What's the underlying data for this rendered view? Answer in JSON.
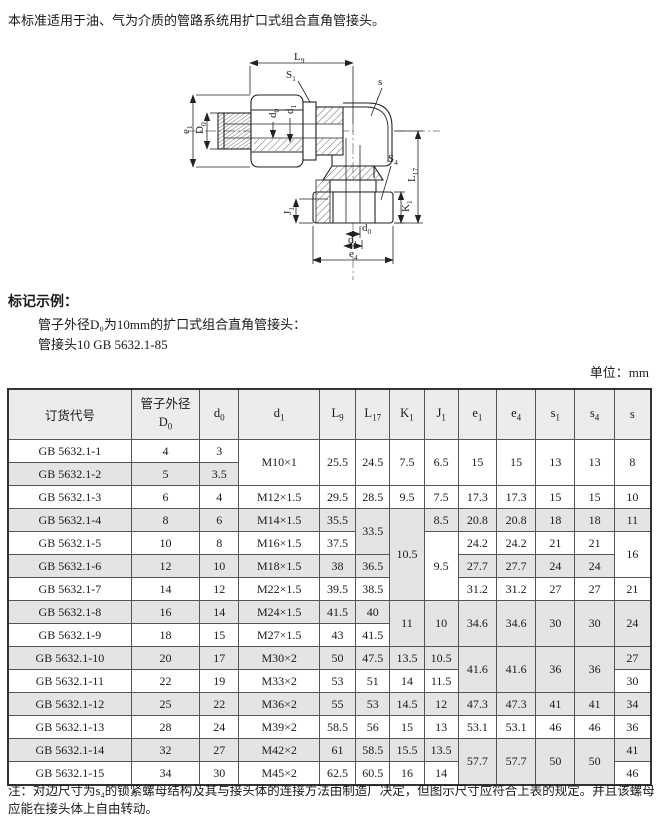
{
  "intro": "本标准适用于油、气为介质的管路系统用扩口式组合直角管接头。",
  "example": {
    "heading": "标记示例：",
    "line1": "管子外径D₀为10mm的扩口式组合直角管接头：",
    "line2": "管接头10 GB 5632.1-85"
  },
  "unit_label": "单位：mm",
  "diagram": {
    "L9": {
      "base": "L",
      "sub": "9"
    },
    "S1": {
      "base": "S",
      "sub": "1"
    },
    "s": {
      "base": "s",
      "sub": ""
    },
    "e1": {
      "base": "e",
      "sub": "1"
    },
    "D0": {
      "base": "D",
      "sub": "0"
    },
    "d0_top": {
      "base": "d",
      "sub": "0"
    },
    "d1_top": {
      "base": "d",
      "sub": "1"
    },
    "L17": {
      "base": "L",
      "sub": "17"
    },
    "S4": {
      "base": "S",
      "sub": "4"
    },
    "K1": {
      "base": "K",
      "sub": "1"
    },
    "J1": {
      "base": "J",
      "sub": "1"
    },
    "d0_bottom": {
      "base": "d",
      "sub": "0"
    },
    "d1_bottom": {
      "base": "d",
      "sub": "1"
    },
    "e4": {
      "base": "e",
      "sub": "4"
    }
  },
  "table": {
    "columns": [
      {
        "label": "订货代号",
        "w": 121
      },
      {
        "line1": "管子外径",
        "base": "D",
        "sub": "0",
        "w": 67
      },
      {
        "base": "d",
        "sub": "0",
        "w": 38
      },
      {
        "base": "d",
        "sub": "1",
        "w": 79
      },
      {
        "base": "L",
        "sub": "9",
        "w": 35
      },
      {
        "base": "L",
        "sub": "17",
        "w": 33
      },
      {
        "base": "K",
        "sub": "1",
        "w": 33
      },
      {
        "base": "J",
        "sub": "1",
        "w": 33
      },
      {
        "base": "e",
        "sub": "1",
        "w": 37
      },
      {
        "base": "e",
        "sub": "4",
        "w": 38
      },
      {
        "base": "s",
        "sub": "1",
        "w": 38
      },
      {
        "base": "s",
        "sub": "4",
        "w": 38
      },
      {
        "base": "s",
        "sub": "",
        "w": 35
      }
    ],
    "rows": [
      {
        "code": "GB 5632.1-1",
        "shaded": false,
        "cells": [
          {
            "v": "4"
          },
          {
            "v": "3"
          },
          {
            "v": "M10×1",
            "rs": 2
          },
          {
            "v": "25.5",
            "rs": 2
          },
          {
            "v": "24.5",
            "rs": 2
          },
          {
            "v": "7.5",
            "rs": 2
          },
          {
            "v": "6.5",
            "rs": 2
          },
          {
            "v": "15",
            "rs": 2
          },
          {
            "v": "15",
            "rs": 2
          },
          {
            "v": "13",
            "rs": 2
          },
          {
            "v": "13",
            "rs": 2
          },
          {
            "v": "8",
            "rs": 2
          }
        ]
      },
      {
        "code": "GB 5632.1-2",
        "shaded": true,
        "cells": [
          {
            "v": "5"
          },
          {
            "v": "3.5"
          }
        ]
      },
      {
        "code": "GB 5632.1-3",
        "shaded": false,
        "cells": [
          {
            "v": "6"
          },
          {
            "v": "4"
          },
          {
            "v": "M12×1.5"
          },
          {
            "v": "29.5"
          },
          {
            "v": "28.5"
          },
          {
            "v": "9.5"
          },
          {
            "v": "7.5"
          },
          {
            "v": "17.3"
          },
          {
            "v": "17.3"
          },
          {
            "v": "15"
          },
          {
            "v": "15"
          },
          {
            "v": "10"
          }
        ]
      },
      {
        "code": "GB 5632.1-4",
        "shaded": true,
        "cells": [
          {
            "v": "8"
          },
          {
            "v": "6"
          },
          {
            "v": "M14×1.5"
          },
          {
            "v": "35.5"
          },
          {
            "v": "33.5",
            "rs": 2
          },
          {
            "v": "10.5",
            "rs": 4
          },
          {
            "v": "8.5"
          },
          {
            "v": "20.8"
          },
          {
            "v": "20.8"
          },
          {
            "v": "18"
          },
          {
            "v": "18"
          },
          {
            "v": "11"
          }
        ]
      },
      {
        "code": "GB 5632.1-5",
        "shaded": false,
        "cells": [
          {
            "v": "10"
          },
          {
            "v": "8"
          },
          {
            "v": "M16×1.5"
          },
          {
            "v": "37.5"
          },
          {
            "v": "9.5",
            "rs": 3
          },
          {
            "v": "24.2"
          },
          {
            "v": "24.2"
          },
          {
            "v": "21"
          },
          {
            "v": "21"
          },
          {
            "v": "16",
            "rs": 2
          }
        ]
      },
      {
        "code": "GB 5632.1-6",
        "shaded": true,
        "cells": [
          {
            "v": "12"
          },
          {
            "v": "10"
          },
          {
            "v": "M18×1.5"
          },
          {
            "v": "38"
          },
          {
            "v": "36.5"
          },
          {
            "v": "27.7"
          },
          {
            "v": "27.7"
          },
          {
            "v": "24"
          },
          {
            "v": "24"
          }
        ]
      },
      {
        "code": "GB 5632.1-7",
        "shaded": false,
        "cells": [
          {
            "v": "14"
          },
          {
            "v": "12"
          },
          {
            "v": "M22×1.5"
          },
          {
            "v": "39.5"
          },
          {
            "v": "38.5"
          },
          {
            "v": "31.2"
          },
          {
            "v": "31.2"
          },
          {
            "v": "27"
          },
          {
            "v": "27"
          },
          {
            "v": "21"
          }
        ]
      },
      {
        "code": "GB 5632.1-8",
        "shaded": true,
        "cells": [
          {
            "v": "16"
          },
          {
            "v": "14"
          },
          {
            "v": "M24×1.5"
          },
          {
            "v": "41.5"
          },
          {
            "v": "40"
          },
          {
            "v": "11",
            "rs": 2
          },
          {
            "v": "10",
            "rs": 2
          },
          {
            "v": "34.6",
            "rs": 2
          },
          {
            "v": "34.6",
            "rs": 2
          },
          {
            "v": "30",
            "rs": 2
          },
          {
            "v": "30",
            "rs": 2
          },
          {
            "v": "24",
            "rs": 2
          }
        ]
      },
      {
        "code": "GB 5632.1-9",
        "shaded": false,
        "cells": [
          {
            "v": "18"
          },
          {
            "v": "15"
          },
          {
            "v": "M27×1.5"
          },
          {
            "v": "43"
          },
          {
            "v": "41.5"
          }
        ]
      },
      {
        "code": "GB 5632.1-10",
        "shaded": true,
        "cells": [
          {
            "v": "20"
          },
          {
            "v": "17"
          },
          {
            "v": "M30×2"
          },
          {
            "v": "50"
          },
          {
            "v": "47.5"
          },
          {
            "v": "13.5"
          },
          {
            "v": "10.5"
          },
          {
            "v": "41.6",
            "rs": 2
          },
          {
            "v": "41.6",
            "rs": 2
          },
          {
            "v": "36",
            "rs": 2
          },
          {
            "v": "36",
            "rs": 2
          },
          {
            "v": "27"
          }
        ]
      },
      {
        "code": "GB 5632.1-11",
        "shaded": false,
        "cells": [
          {
            "v": "22"
          },
          {
            "v": "19"
          },
          {
            "v": "M33×2"
          },
          {
            "v": "53"
          },
          {
            "v": "51"
          },
          {
            "v": "14"
          },
          {
            "v": "11.5"
          },
          {
            "v": "30"
          }
        ]
      },
      {
        "code": "GB 5632.1-12",
        "shaded": true,
        "cells": [
          {
            "v": "25"
          },
          {
            "v": "22"
          },
          {
            "v": "M36×2"
          },
          {
            "v": "55"
          },
          {
            "v": "53"
          },
          {
            "v": "14.5"
          },
          {
            "v": "12"
          },
          {
            "v": "47.3"
          },
          {
            "v": "47.3"
          },
          {
            "v": "41"
          },
          {
            "v": "41"
          },
          {
            "v": "34"
          }
        ]
      },
      {
        "code": "GB 5632.1-13",
        "shaded": false,
        "cells": [
          {
            "v": "28"
          },
          {
            "v": "24"
          },
          {
            "v": "M39×2"
          },
          {
            "v": "58.5"
          },
          {
            "v": "56"
          },
          {
            "v": "15"
          },
          {
            "v": "13"
          },
          {
            "v": "53.1"
          },
          {
            "v": "53.1"
          },
          {
            "v": "46"
          },
          {
            "v": "46"
          },
          {
            "v": "36"
          }
        ]
      },
      {
        "code": "GB 5632.1-14",
        "shaded": true,
        "cells": [
          {
            "v": "32"
          },
          {
            "v": "27"
          },
          {
            "v": "M42×2"
          },
          {
            "v": "61"
          },
          {
            "v": "58.5"
          },
          {
            "v": "15.5"
          },
          {
            "v": "13.5"
          },
          {
            "v": "57.7",
            "rs": 2
          },
          {
            "v": "57.7",
            "rs": 2
          },
          {
            "v": "50",
            "rs": 2
          },
          {
            "v": "50",
            "rs": 2
          },
          {
            "v": "41"
          }
        ]
      },
      {
        "code": "GB 5632.1-15",
        "shaded": false,
        "cells": [
          {
            "v": "34"
          },
          {
            "v": "30"
          },
          {
            "v": "M45×2"
          },
          {
            "v": "62.5"
          },
          {
            "v": "60.5"
          },
          {
            "v": "16"
          },
          {
            "v": "14"
          },
          {
            "v": "46"
          }
        ]
      }
    ]
  },
  "note": "注：对边尺寸为s₄的锁紧螺母结构及其与接头体的连接方法由制造厂决定，但图示尺寸应符合上表的规定。并且该螺母应能在接头体上自由转动。"
}
